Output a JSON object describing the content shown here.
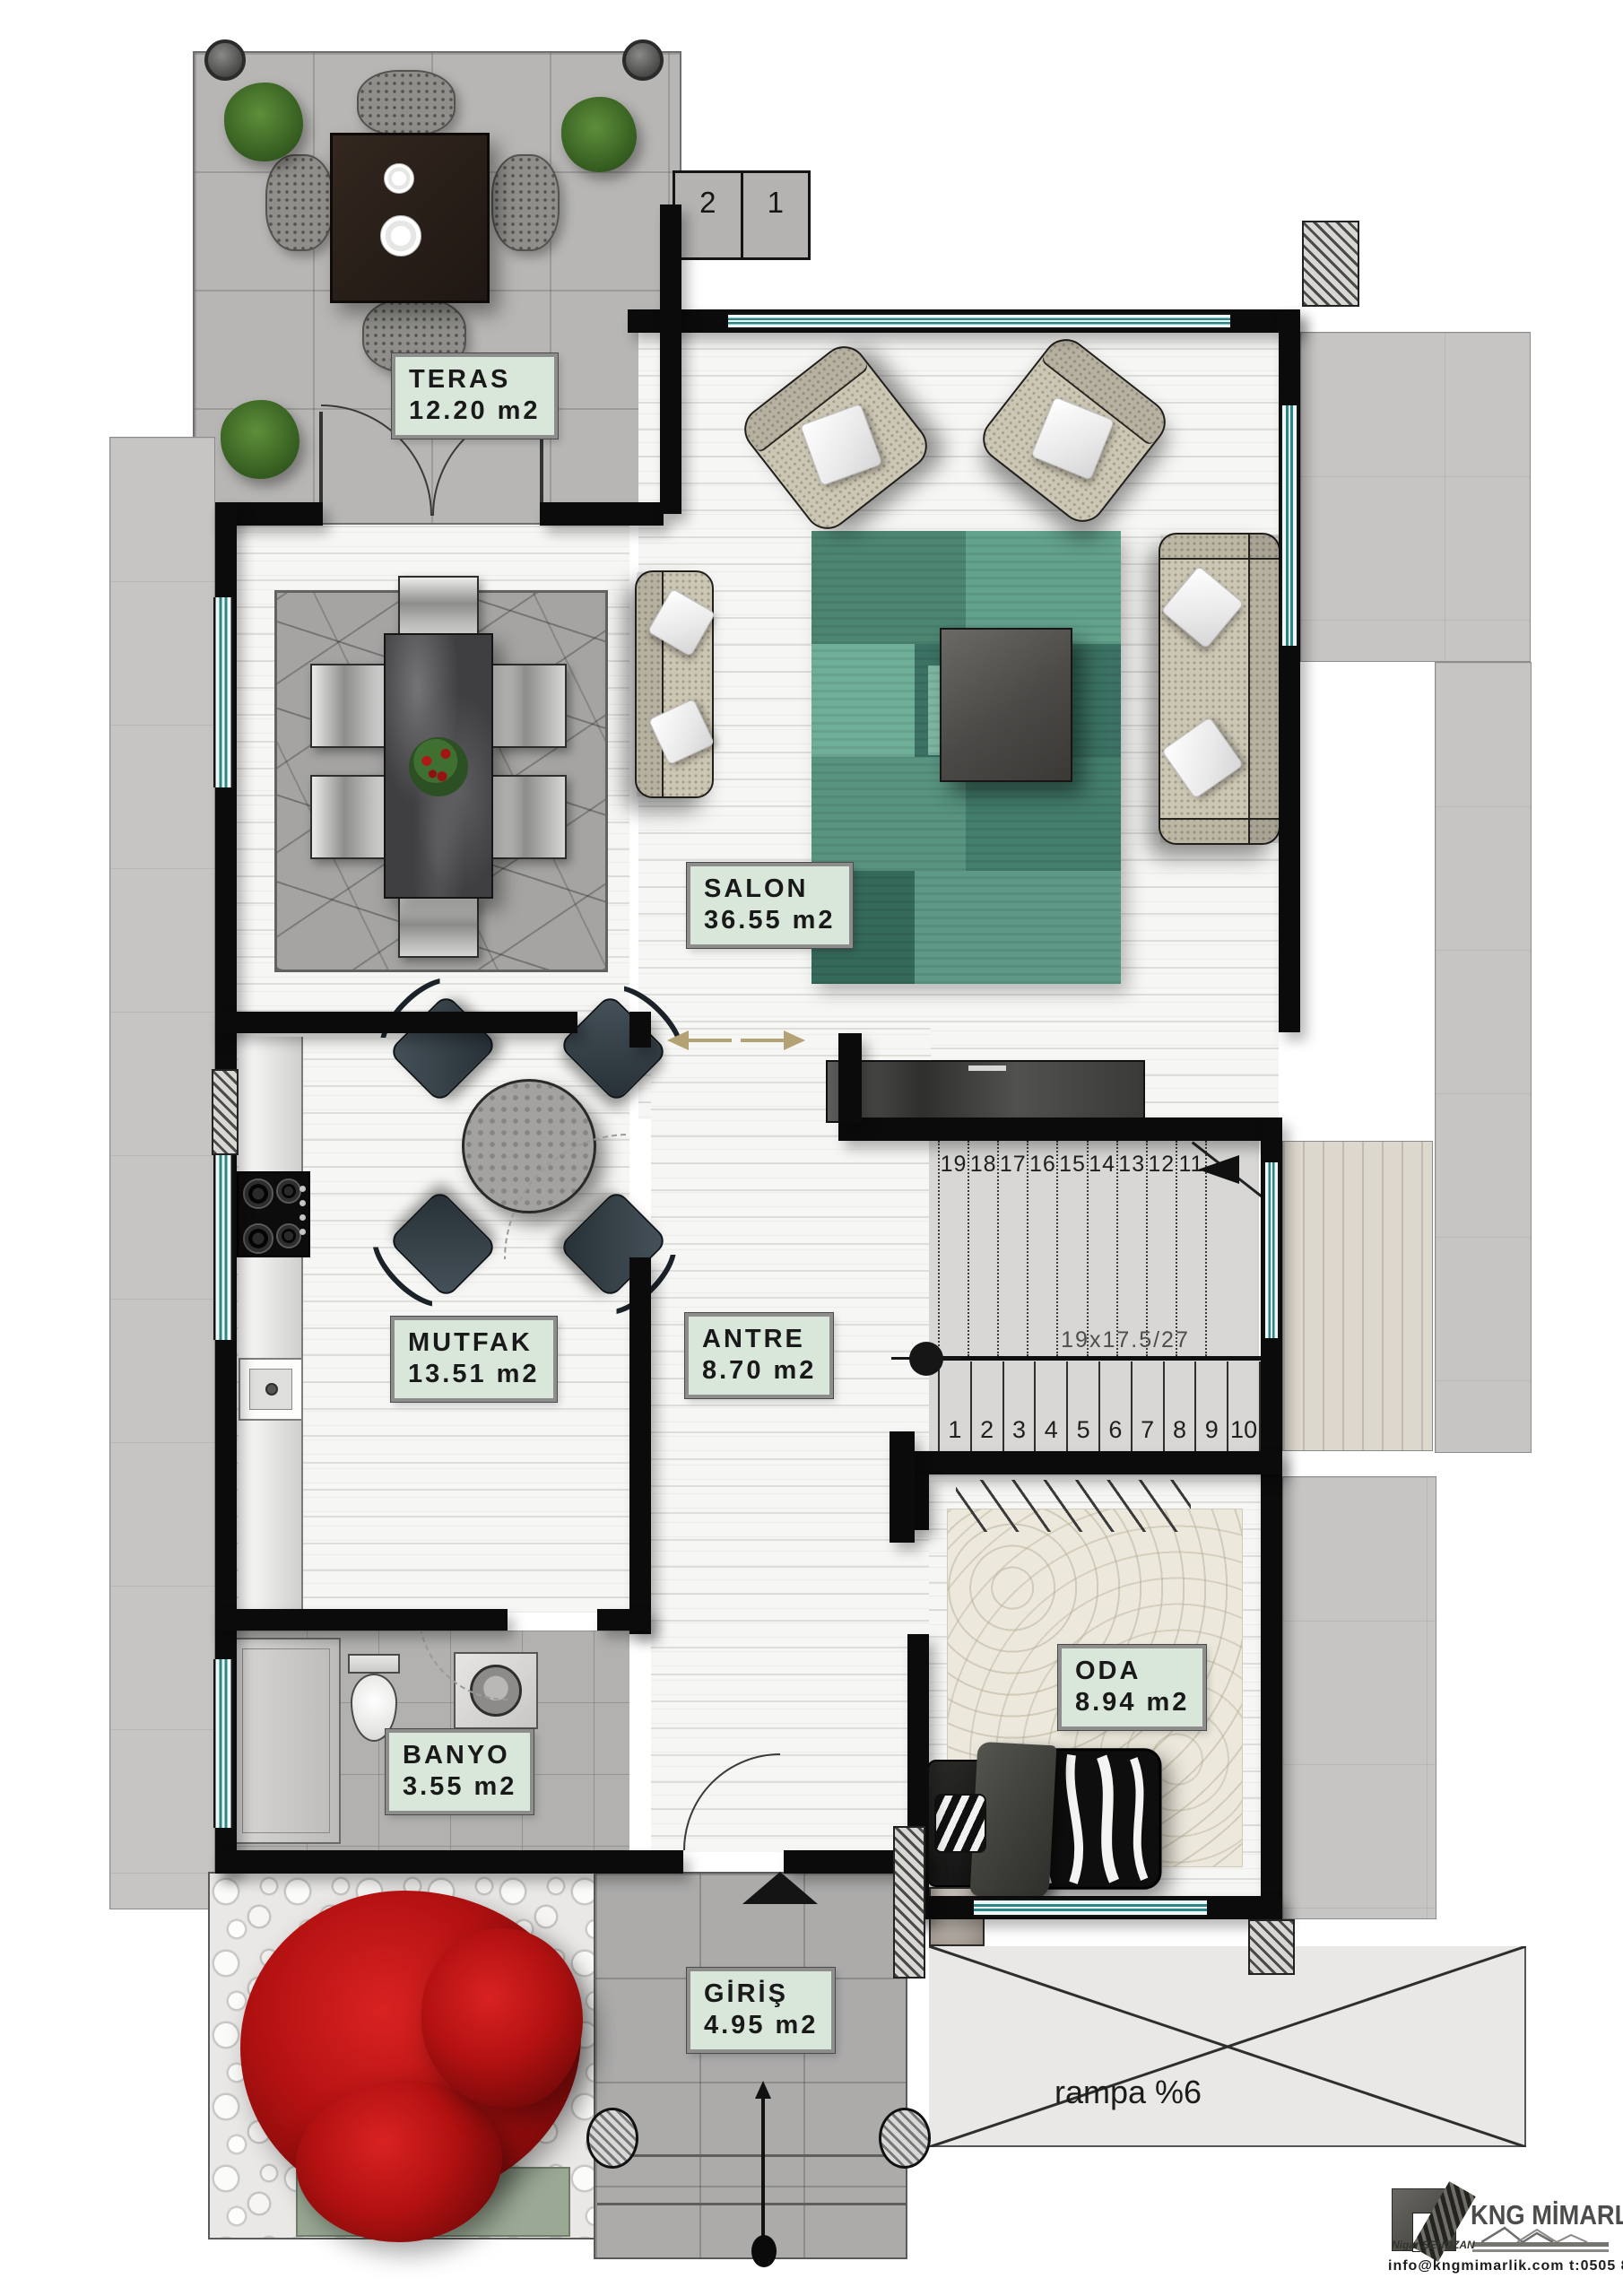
{
  "rooms": {
    "teras": {
      "name": "TERAS",
      "area": "12.20 m2"
    },
    "salon": {
      "name": "SALON",
      "area": "36.55 m2"
    },
    "mutfak": {
      "name": "MUTFAK",
      "area": "13.51 m2"
    },
    "antre": {
      "name": "ANTRE",
      "area": "8.70 m2"
    },
    "banyo": {
      "name": "BANYO",
      "area": "3.55 m2"
    },
    "oda": {
      "name": "ODA",
      "area": "8.94 m2"
    },
    "giris": {
      "name": "GİRİŞ",
      "area": "4.95 m2"
    }
  },
  "stairs": {
    "upper_run_numbers": [
      "19",
      "18",
      "17",
      "16",
      "15",
      "14",
      "13",
      "12",
      "11"
    ],
    "lower_run_numbers": [
      "1",
      "2",
      "3",
      "4",
      "5",
      "6",
      "7",
      "8",
      "9",
      "10"
    ],
    "dimension_note": "19x17.5/27"
  },
  "entry_steps": [
    "2",
    "1"
  ],
  "ramp": {
    "label": "rampa %6"
  },
  "logo": {
    "brand": "KNG MİMARLIK",
    "signature": "Nigar ŞENOZAN",
    "contact": "info@kngmimarlik.com  t:0505 806 91 67"
  },
  "colors": {
    "label_bg": "#d9e7db",
    "wall": "#0b0b0b",
    "window_glass": "#2d8686",
    "living_rug_green": "#4f8a77",
    "tree_red": "#b51414",
    "bedroom_carpet": "#ece9dc",
    "exterior_concrete": "#b7b6b4"
  }
}
